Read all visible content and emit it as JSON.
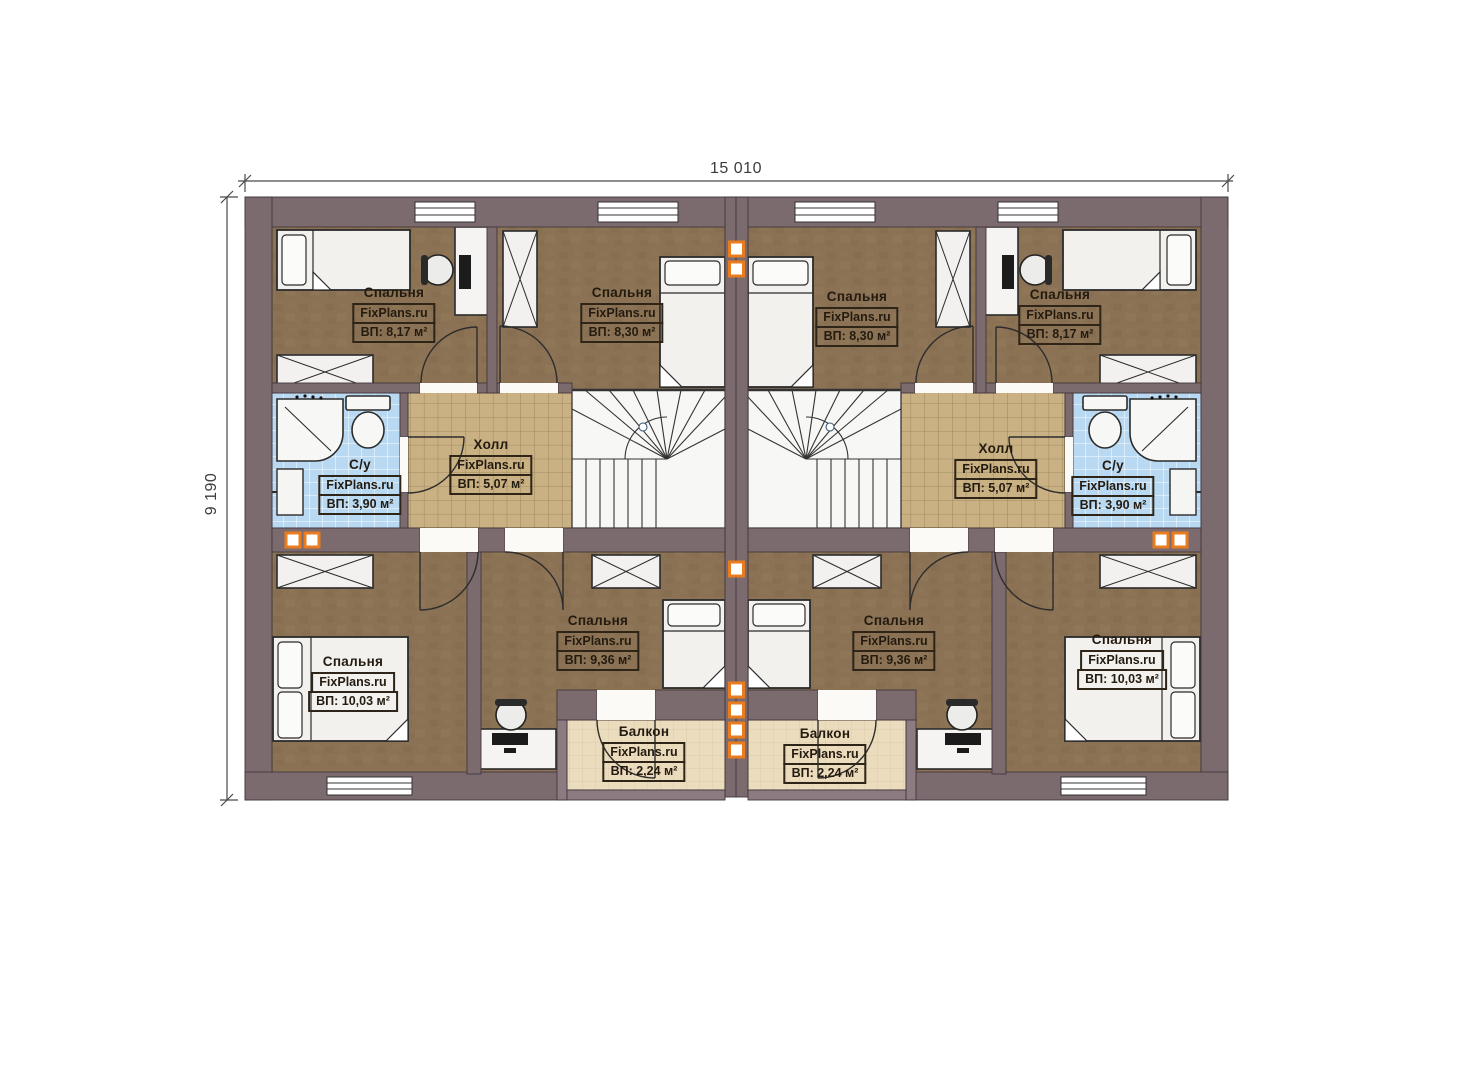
{
  "page": {
    "background": "#ffffff"
  },
  "plan": {
    "brand_watermark": "FixPlans.ru",
    "dimensions": {
      "width_label": "15 010",
      "height_label": "9 190"
    },
    "colors": {
      "wall": "#7b6a6e",
      "wall_outline": "#42383c",
      "balcony_parapet": "#8c7b80",
      "bedroom_floor": "#8b7254",
      "hall_floor": "#c9b184",
      "bath_floor": "#b9d9f2",
      "balcony_floor": "#ecdcbe",
      "stairs_floor": "#f7f7f5",
      "vent_accent": "#e87c1e",
      "furniture": "#f5f4f2",
      "drawing_line": "#2b2b2b"
    },
    "rooms": [
      {
        "name": "Спальня",
        "brand": "FixPlans.ru",
        "area": "ВП: 8,17 м²",
        "x": 394,
        "y": 314
      },
      {
        "name": "Спальня",
        "brand": "FixPlans.ru",
        "area": "ВП: 8,30 м²",
        "x": 622,
        "y": 314
      },
      {
        "name": "Спальня",
        "brand": "FixPlans.ru",
        "area": "ВП: 8,30 м²",
        "x": 857,
        "y": 318
      },
      {
        "name": "Спальня",
        "brand": "FixPlans.ru",
        "area": "ВП: 8,17 м²",
        "x": 1060,
        "y": 316
      },
      {
        "name": "С/у",
        "brand": "FixPlans.ru",
        "area": "ВП: 3,90 м²",
        "x": 360,
        "y": 486
      },
      {
        "name": "Холл",
        "brand": "FixPlans.ru",
        "area": "ВП: 5,07 м²",
        "x": 491,
        "y": 466
      },
      {
        "name": "Холл",
        "brand": "FixPlans.ru",
        "area": "ВП: 5,07 м²",
        "x": 996,
        "y": 470
      },
      {
        "name": "С/у",
        "brand": "FixPlans.ru",
        "area": "ВП: 3,90 м²",
        "x": 1113,
        "y": 487
      },
      {
        "name": "Спальня",
        "brand": "FixPlans.ru",
        "area": "ВП: 10,03 м²",
        "x": 353,
        "y": 683
      },
      {
        "name": "Спальня",
        "brand": "FixPlans.ru",
        "area": "ВП: 9,36 м²",
        "x": 598,
        "y": 642
      },
      {
        "name": "Спальня",
        "brand": "FixPlans.ru",
        "area": "ВП: 9,36 м²",
        "x": 894,
        "y": 642
      },
      {
        "name": "Спальня",
        "brand": "FixPlans.ru",
        "area": "ВП: 10,03 м²",
        "x": 1122,
        "y": 661
      },
      {
        "name": "Балкон",
        "brand": "FixPlans.ru",
        "area": "ВП: 2,24 м²",
        "x": 644,
        "y": 753
      },
      {
        "name": "Балкон",
        "brand": "FixPlans.ru",
        "area": "ВП: 2,24 м²",
        "x": 825,
        "y": 755
      }
    ]
  }
}
